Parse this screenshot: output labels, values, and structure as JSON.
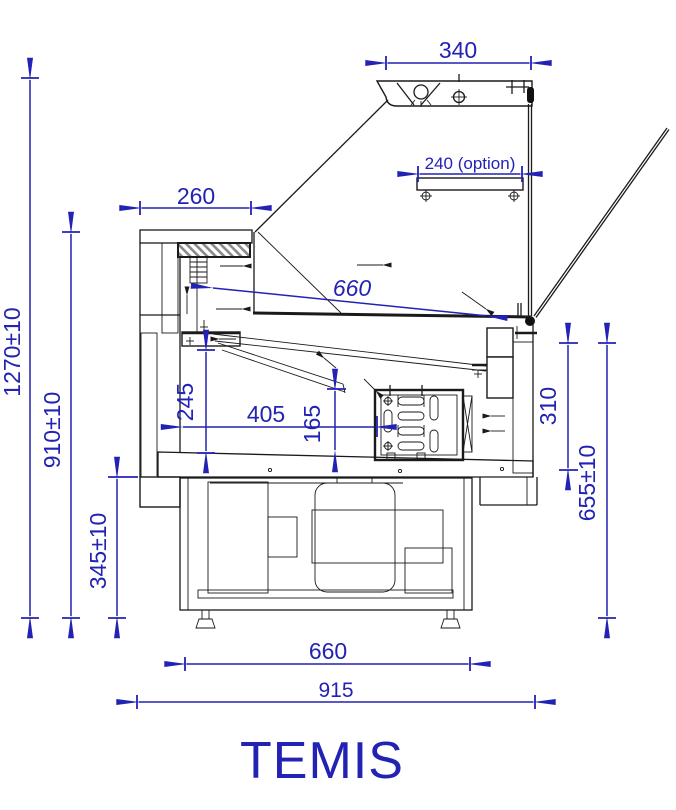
{
  "title": "TEMIS",
  "colors": {
    "dimension_blue": "#2222b4",
    "line_black": "#1a1a1a",
    "hatch_gray": "#a8a8a8",
    "background": "#ffffff"
  },
  "labels": {
    "dim_canopy_width": "340",
    "dim_shelf_option": "240 (option)",
    "dim_counter_depth": "260",
    "dim_display_depth": "660",
    "dim_total_height": "1270±10",
    "dim_worktop_height": "910±10",
    "dim_base_height": "345±10",
    "dim_well_height": "245",
    "dim_well_depth": "405",
    "dim_evaporator_height": "165",
    "dim_front_glass_height": "310",
    "dim_front_total_height": "655±10",
    "dim_base_depth": "660",
    "dim_overall_depth": "915"
  }
}
